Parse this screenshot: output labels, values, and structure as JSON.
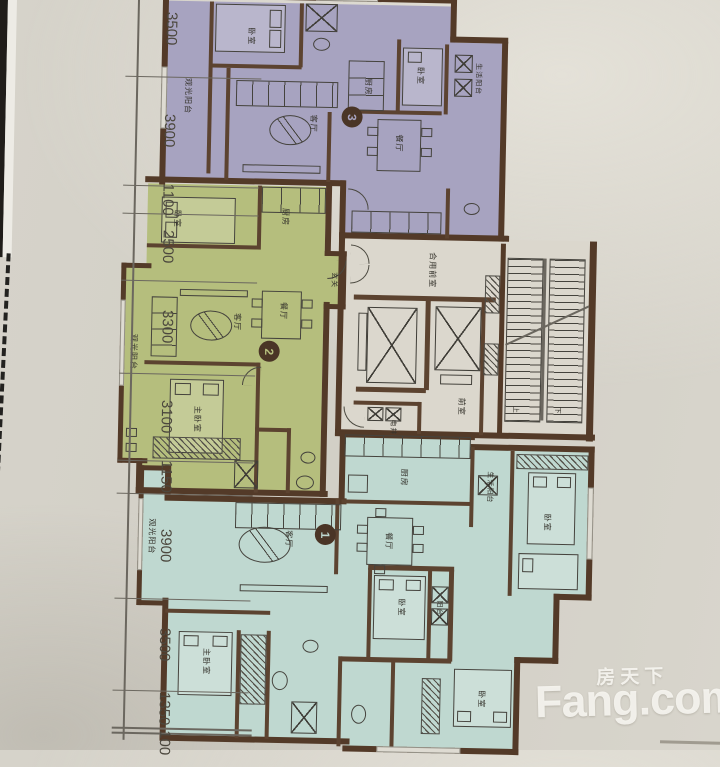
{
  "watermark": {
    "brand": "Fang.com",
    "cn": "房天下"
  },
  "ruler": {
    "dims": [
      "3500",
      "3900",
      "1100",
      "2500",
      "3300",
      "3100",
      "1150",
      "3900",
      "3500",
      "1350",
      "100"
    ]
  },
  "units": {
    "u1": "1",
    "u2": "2",
    "u3": "3"
  },
  "rooms": {
    "u3_balcony": "观光阳台",
    "u3_bedroom": "卧室",
    "u3_living": "客厅",
    "u3_kitchen": "厨房",
    "u3_bedroom_r": "卧室",
    "u3_balcony_r": "生活阳台",
    "u3_dining": "餐厅",
    "u2_bedroom": "卧室",
    "u2_kitchen": "厨房",
    "u2_living": "客厅",
    "u2_dining": "餐厅",
    "u2_master": "主卧室",
    "u2_balcony": "观光阳台",
    "u2_foyer": "玄关",
    "u1_living": "客厅",
    "u1_dining": "餐厅",
    "u1_kitchen": "厨房",
    "u1_service": "生活阳台",
    "u1_balcony": "观光阳台",
    "u1_master": "主卧室",
    "u1_bedroom_c": "卧室",
    "u1_bedroom_a": "卧室",
    "u1_bedroom_b": "卧室",
    "u1_balcony_b": "阳台"
  },
  "core": {
    "shared_lobby": "合用前室",
    "lobby": "前室",
    "shaft": "电井",
    "up": "上",
    "down": "下"
  },
  "colors": {
    "unit1": "#bfd8d0",
    "unit2": "#b5be7d",
    "unit3": "#a7a3c0",
    "wall": "#533a28",
    "paper": "#d4d1c8",
    "core_bg": "#dbd7cd"
  }
}
